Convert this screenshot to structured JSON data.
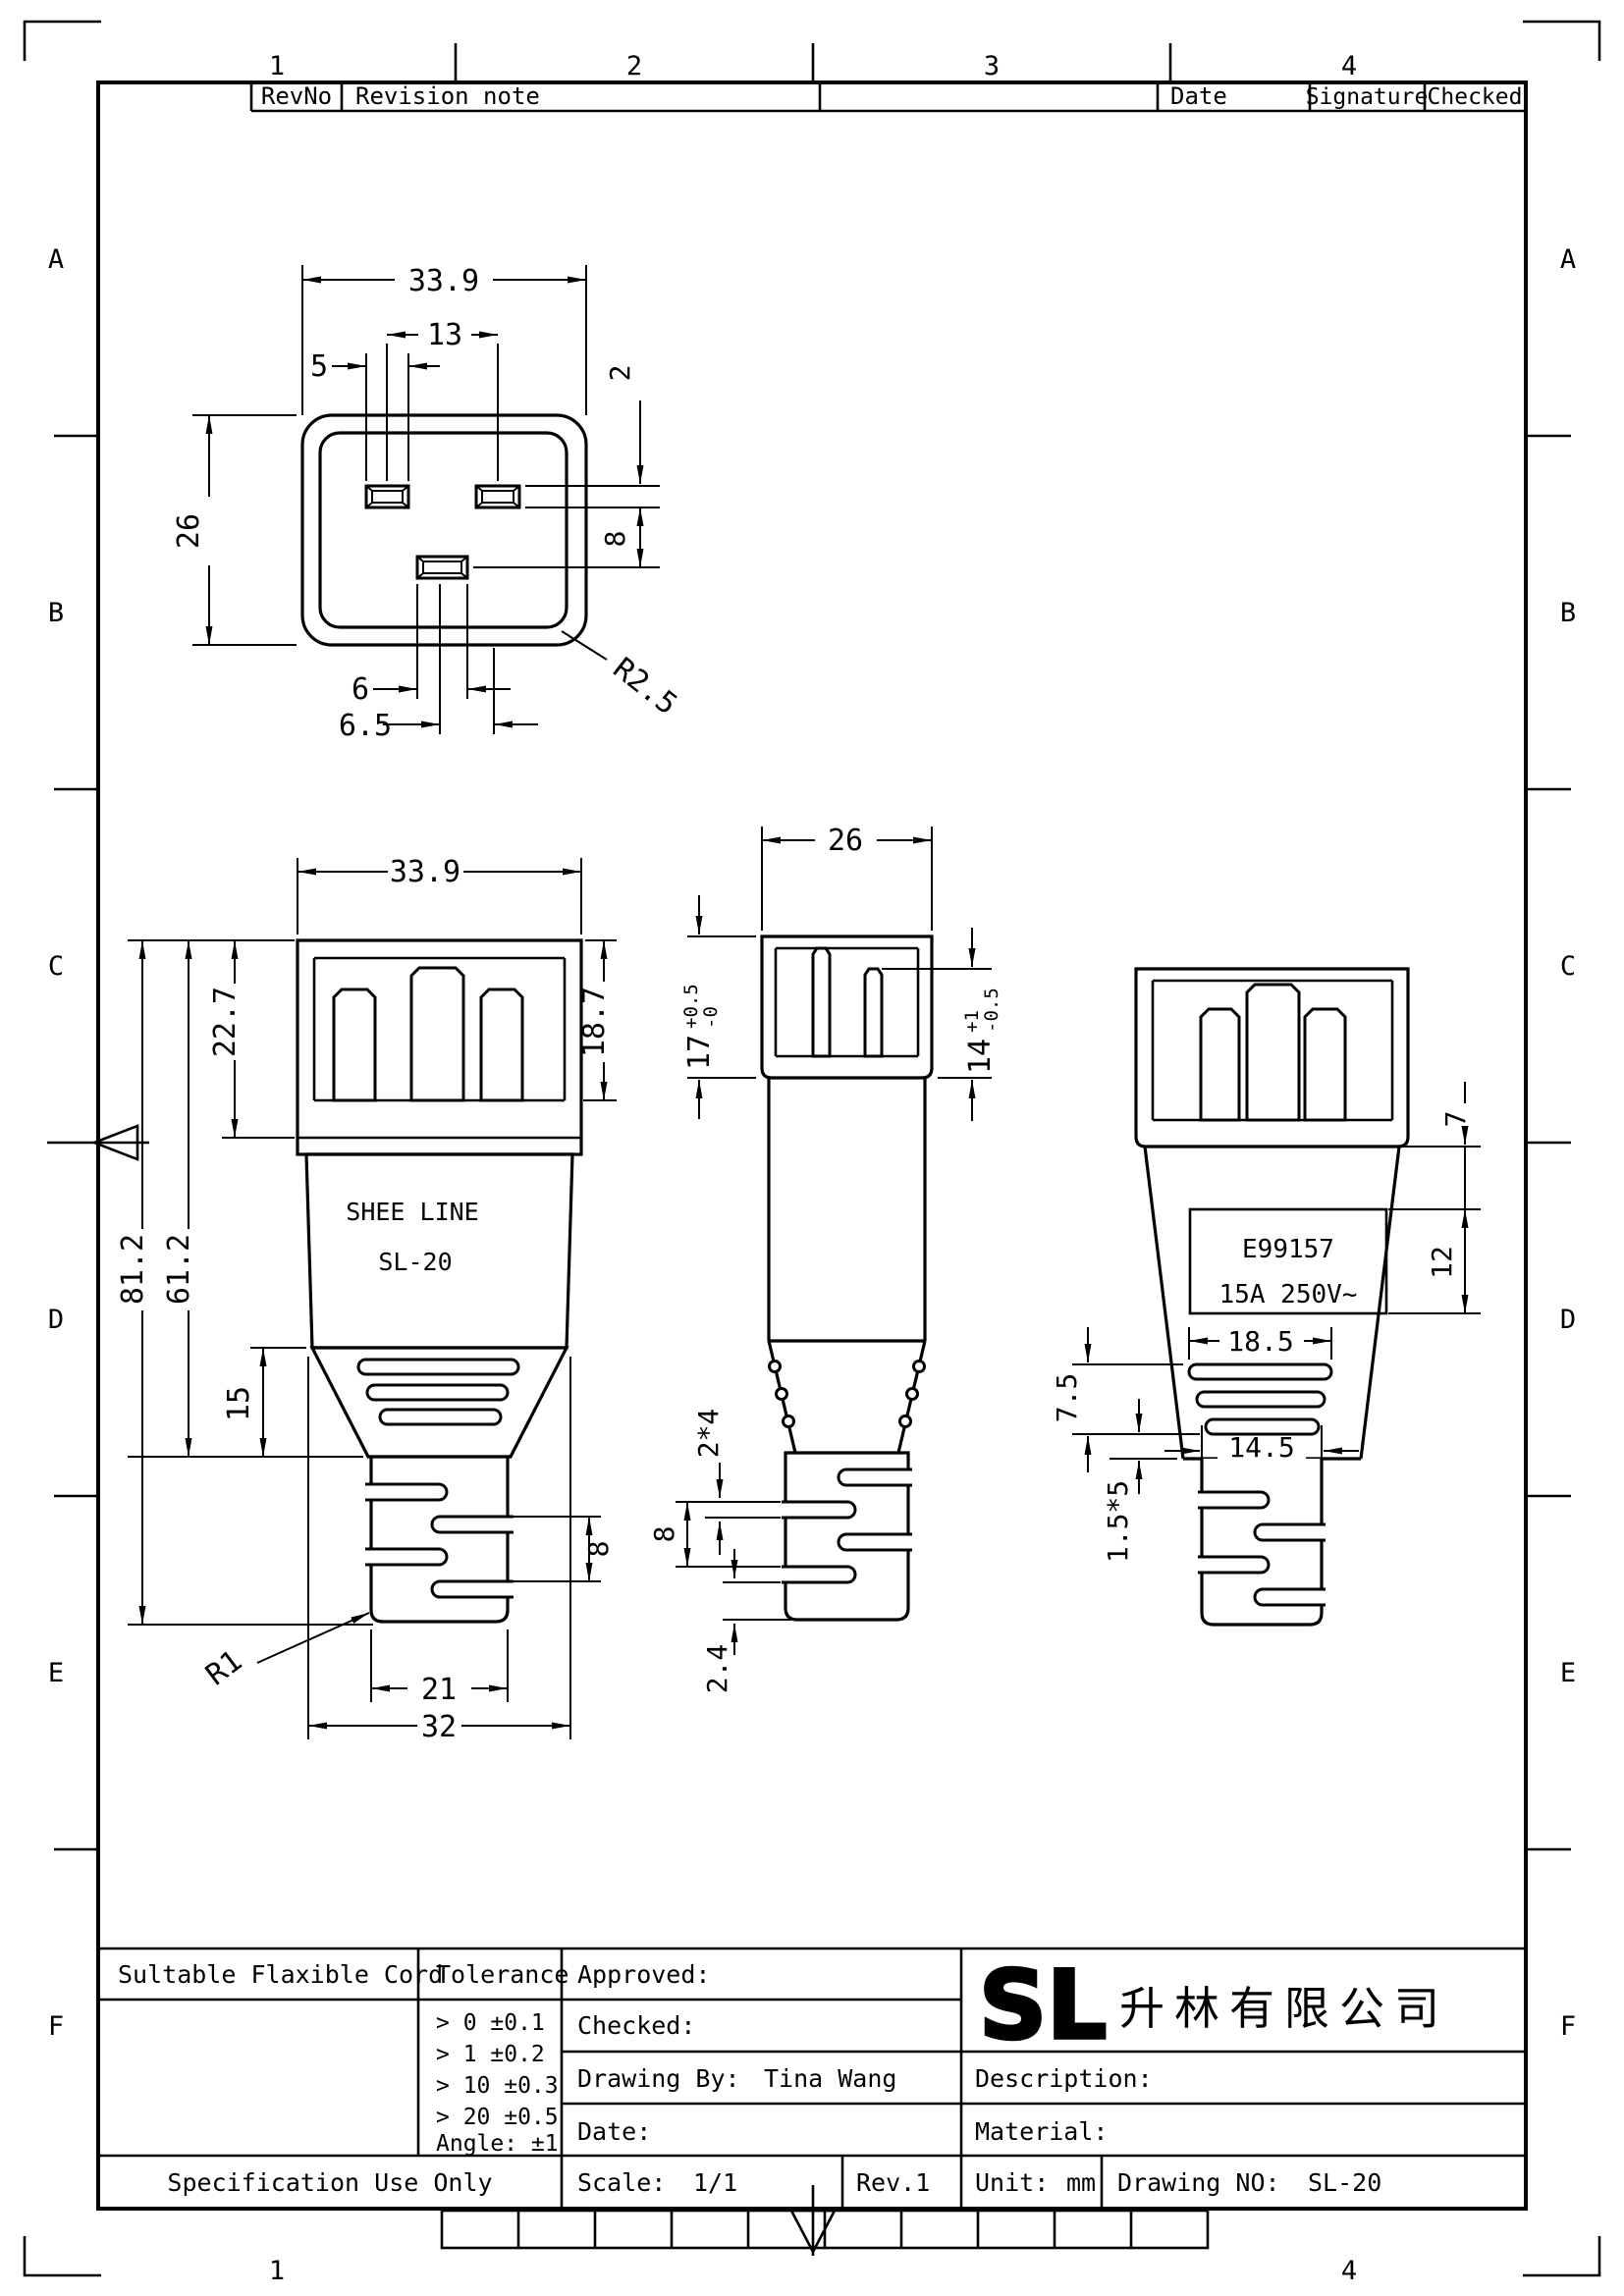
{
  "frame": {
    "cols_top": [
      "1",
      "2",
      "3",
      "4"
    ],
    "cols_bottom": [
      "1",
      "4"
    ],
    "rows": [
      "A",
      "B",
      "C",
      "D",
      "E",
      "F"
    ]
  },
  "revision_table": {
    "rev_no": "RevNo",
    "note": "Revision note",
    "date": "Date",
    "signature": "Signature",
    "checked": "Checked"
  },
  "top_view": {
    "width": "33.9",
    "pin_pitch": "13",
    "pin_width": "5",
    "height": "26",
    "slot_thickness": "2",
    "row_offset": "8",
    "corner_radius": "R2.5",
    "earth_width": "6",
    "earth_offset": "6.5"
  },
  "front_view": {
    "width": "33.9",
    "shroud_height": "22.7",
    "shroud_depth": "18.7",
    "overall_length": "81.2",
    "body_length": "61.2",
    "taper_length": "15",
    "grip_slot_pitch": "8",
    "bottom_radius": "R1",
    "relief_width": "21",
    "body_width": "32",
    "brand_line1": "SHEE LINE",
    "brand_line2": "SL-20"
  },
  "side_view": {
    "width": "26",
    "shroud_len": "17",
    "shroud_tol_plus": "+0.5",
    "shroud_tol_minus": "-0",
    "pin_len": "14",
    "pin_tol_plus": "+1",
    "pin_tol_minus": "-0.5",
    "slot_spec": "2*4",
    "slot_pitch": "8",
    "end_gap": "2.4"
  },
  "rear_view": {
    "label_offset": "7",
    "label_height": "12",
    "cert_no": "E99157",
    "rating": "15A 250V~",
    "vent_width": "18.5",
    "vent_height": "7.5",
    "rib_spec": "1.5*5",
    "relief_width": "14.5"
  },
  "title_block": {
    "cord": "Sultable Flaxible Cord",
    "tolerance_title": "Tolerance",
    "tol_rows": [
      "> 0  ±0.1",
      "> 1  ±0.2",
      "> 10  ±0.3",
      "> 20  ±0.5",
      "Angle: ±1"
    ],
    "spec_only": "Specification Use Only",
    "approved": "Approved:",
    "checked": "Checked:",
    "drawing_by": "Drawing By:",
    "drawing_by_value": "Tina Wang",
    "date": "Date:",
    "scale": "Scale:",
    "scale_value": "1/1",
    "rev": "Rev.1",
    "logo_text": "SL",
    "logo_color": "#2bd52b",
    "company": "升林有限公司",
    "description": "Description:",
    "material": "Material:",
    "unit": "Unit:",
    "unit_value": "mm",
    "drawing_no": "Drawing NO:",
    "drawing_no_value": "SL-20"
  }
}
